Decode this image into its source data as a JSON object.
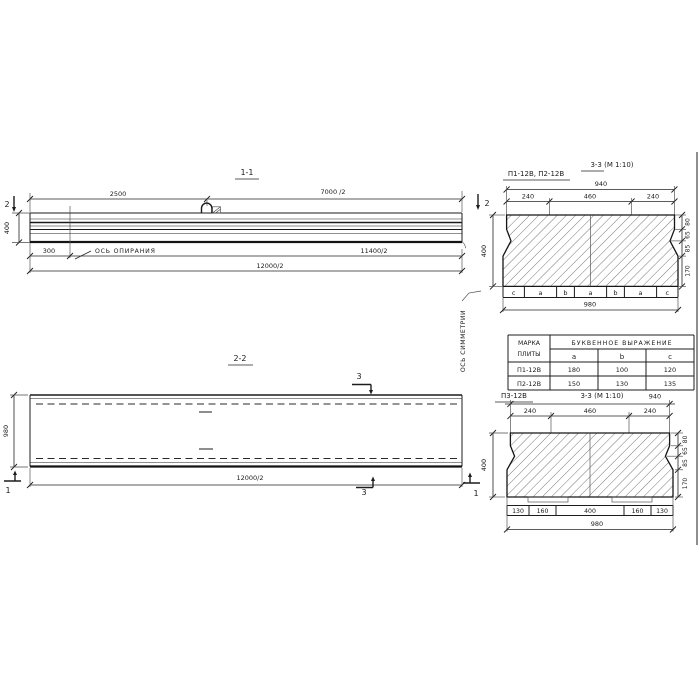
{
  "drawing": {
    "section_1_1": {
      "title": "1-1",
      "dim_left_span": "2500",
      "dim_right_span": "7000 /2",
      "marker_left": "2",
      "marker_right": "2",
      "dim_height": "400",
      "dim_support_offset": "300",
      "support_axis_label": "ОСЬ ОПИРАНИЯ",
      "dim_half_span": "11400/2",
      "dim_half_total": "12000/2"
    },
    "section_2_2": {
      "title": "2-2",
      "dim_width": "980",
      "dim_half_total": "12000/2",
      "marker_top": "3",
      "marker_bottom": "3",
      "marker_left": "1",
      "marker_right": "1",
      "symmetry_axis_label": "ОСЬ СИММЕТРИИ"
    },
    "section_3_3_top": {
      "marks_label": "П1-12В, П2-12В",
      "title": "3-3 (М 1:10)",
      "dim_top_total": "940",
      "dim_top_segments": [
        "240",
        "460",
        "240"
      ],
      "dim_height": "400",
      "dim_right_segments": [
        "80",
        "65",
        "85",
        "170"
      ],
      "bottom_letters": [
        "c",
        "a",
        "b",
        "a",
        "b",
        "a",
        "c"
      ],
      "dim_bottom_total": "980"
    },
    "table": {
      "header_col1_line1": "МАРКА",
      "header_col1_line2": "ПЛИТЫ",
      "header_expr": "БУКВЕННОЕ ВЫРАЖЕНИЕ",
      "cols": [
        "a",
        "b",
        "c"
      ],
      "rows": [
        {
          "mark": "П1-12В",
          "a": "180",
          "b": "100",
          "c": "120"
        },
        {
          "mark": "П2-12В",
          "a": "150",
          "b": "130",
          "c": "135"
        }
      ]
    },
    "section_3_3_bottom": {
      "mark_label": "П3-12В",
      "title": "3-3 (М 1:10)",
      "dim_top_total": "940",
      "dim_top_segments": [
        "240",
        "460",
        "240"
      ],
      "dim_height": "400",
      "dim_right_segments": [
        "80",
        "65",
        "85",
        "170"
      ],
      "dim_bottom_segments": [
        "130",
        "160",
        "400",
        "160",
        "130"
      ],
      "dim_bottom_total": "980"
    }
  }
}
